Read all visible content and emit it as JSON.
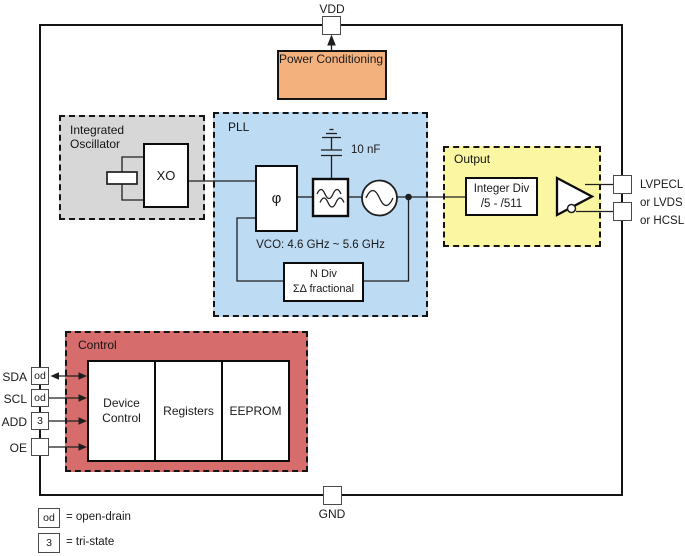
{
  "blocks": {
    "power_conditioning": {
      "label": "Power Conditioning"
    },
    "oscillator": {
      "title": "Integrated Oscillator",
      "xo_label": "XO"
    },
    "pll": {
      "title": "PLL",
      "phase_detector_symbol": "φ",
      "cap_label": "10 nF",
      "vco_label": "VCO: 4.6 GHz ~ 5.6 GHz",
      "n_divider": {
        "line1": "N Div",
        "line2": "ΣΔ fractional"
      }
    },
    "output": {
      "title": "Output",
      "divider": {
        "line1": "Integer Div",
        "line2": "/5 - /511"
      },
      "signal_types": [
        "LVPECL",
        "or LVDS",
        "or HCSL"
      ]
    },
    "control": {
      "title": "Control",
      "cells": [
        "Device Control",
        "Registers",
        "EEPROM"
      ]
    }
  },
  "pins": {
    "vdd": "VDD",
    "gnd": "GND",
    "left": [
      {
        "name": "SDA",
        "pad": "od"
      },
      {
        "name": "SCL",
        "pad": "od"
      },
      {
        "name": "ADD",
        "pad": "3"
      },
      {
        "name": "OE",
        "pad": ""
      }
    ]
  },
  "legend": [
    {
      "symbol": "od",
      "meaning": "= open-drain"
    },
    {
      "symbol": "3",
      "meaning": "= tri-state"
    }
  ],
  "colors": {
    "power_block": "#F3B17D",
    "oscillator_block": "#D7D7D7",
    "pll_block": "#BEDBF4",
    "output_block": "#FAF6A2",
    "control_block": "#D66C6C",
    "wire": "#1F1F1F"
  }
}
